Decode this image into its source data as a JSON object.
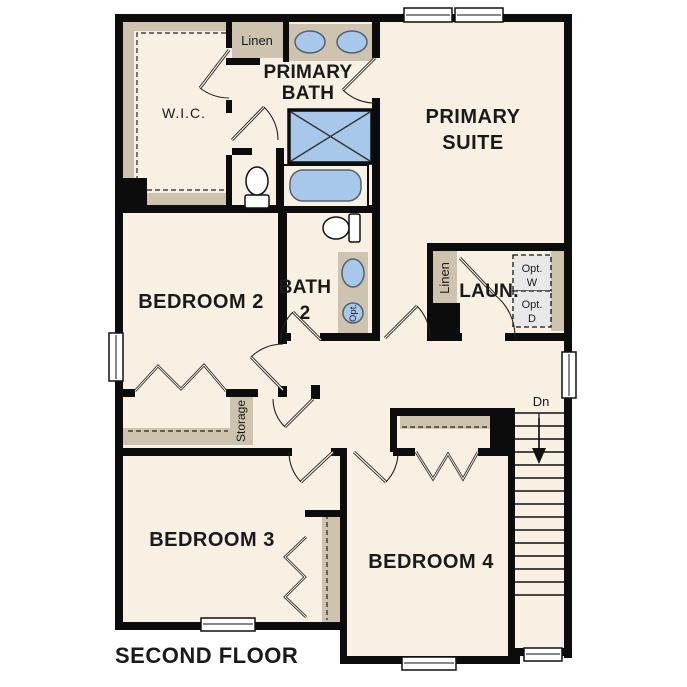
{
  "plan": {
    "title": "SECOND FLOOR",
    "labels": {
      "wic": "W.I.C.",
      "linen_top": "Linen",
      "primary_bath_1": "PRIMARY",
      "primary_bath_2": "BATH",
      "primary_suite_1": "PRIMARY",
      "primary_suite_2": "SUITE",
      "bedroom2": "BEDROOM 2",
      "bath2_1": "BATH",
      "bath2_2": "2",
      "opt_sink": "Opt.",
      "laundry": "LAUN.",
      "linen_laundry": "Linen",
      "opt_washer_1": "Opt.",
      "opt_washer_2": "W",
      "opt_dryer_1": "Opt.",
      "opt_dryer_2": "D",
      "storage": "Storage",
      "bedroom3": "BEDROOM 3",
      "bedroom4": "BEDROOM 4",
      "stairs_down": "Dn"
    },
    "colors": {
      "floor": "#f7f0e3",
      "wall": "#0c0c0c",
      "cabinet_tan": "#cdc3ae",
      "fixture_blue": "#a7c8e9",
      "optional_gray": "#e9e9e9",
      "text": "#1a1a1a"
    }
  }
}
